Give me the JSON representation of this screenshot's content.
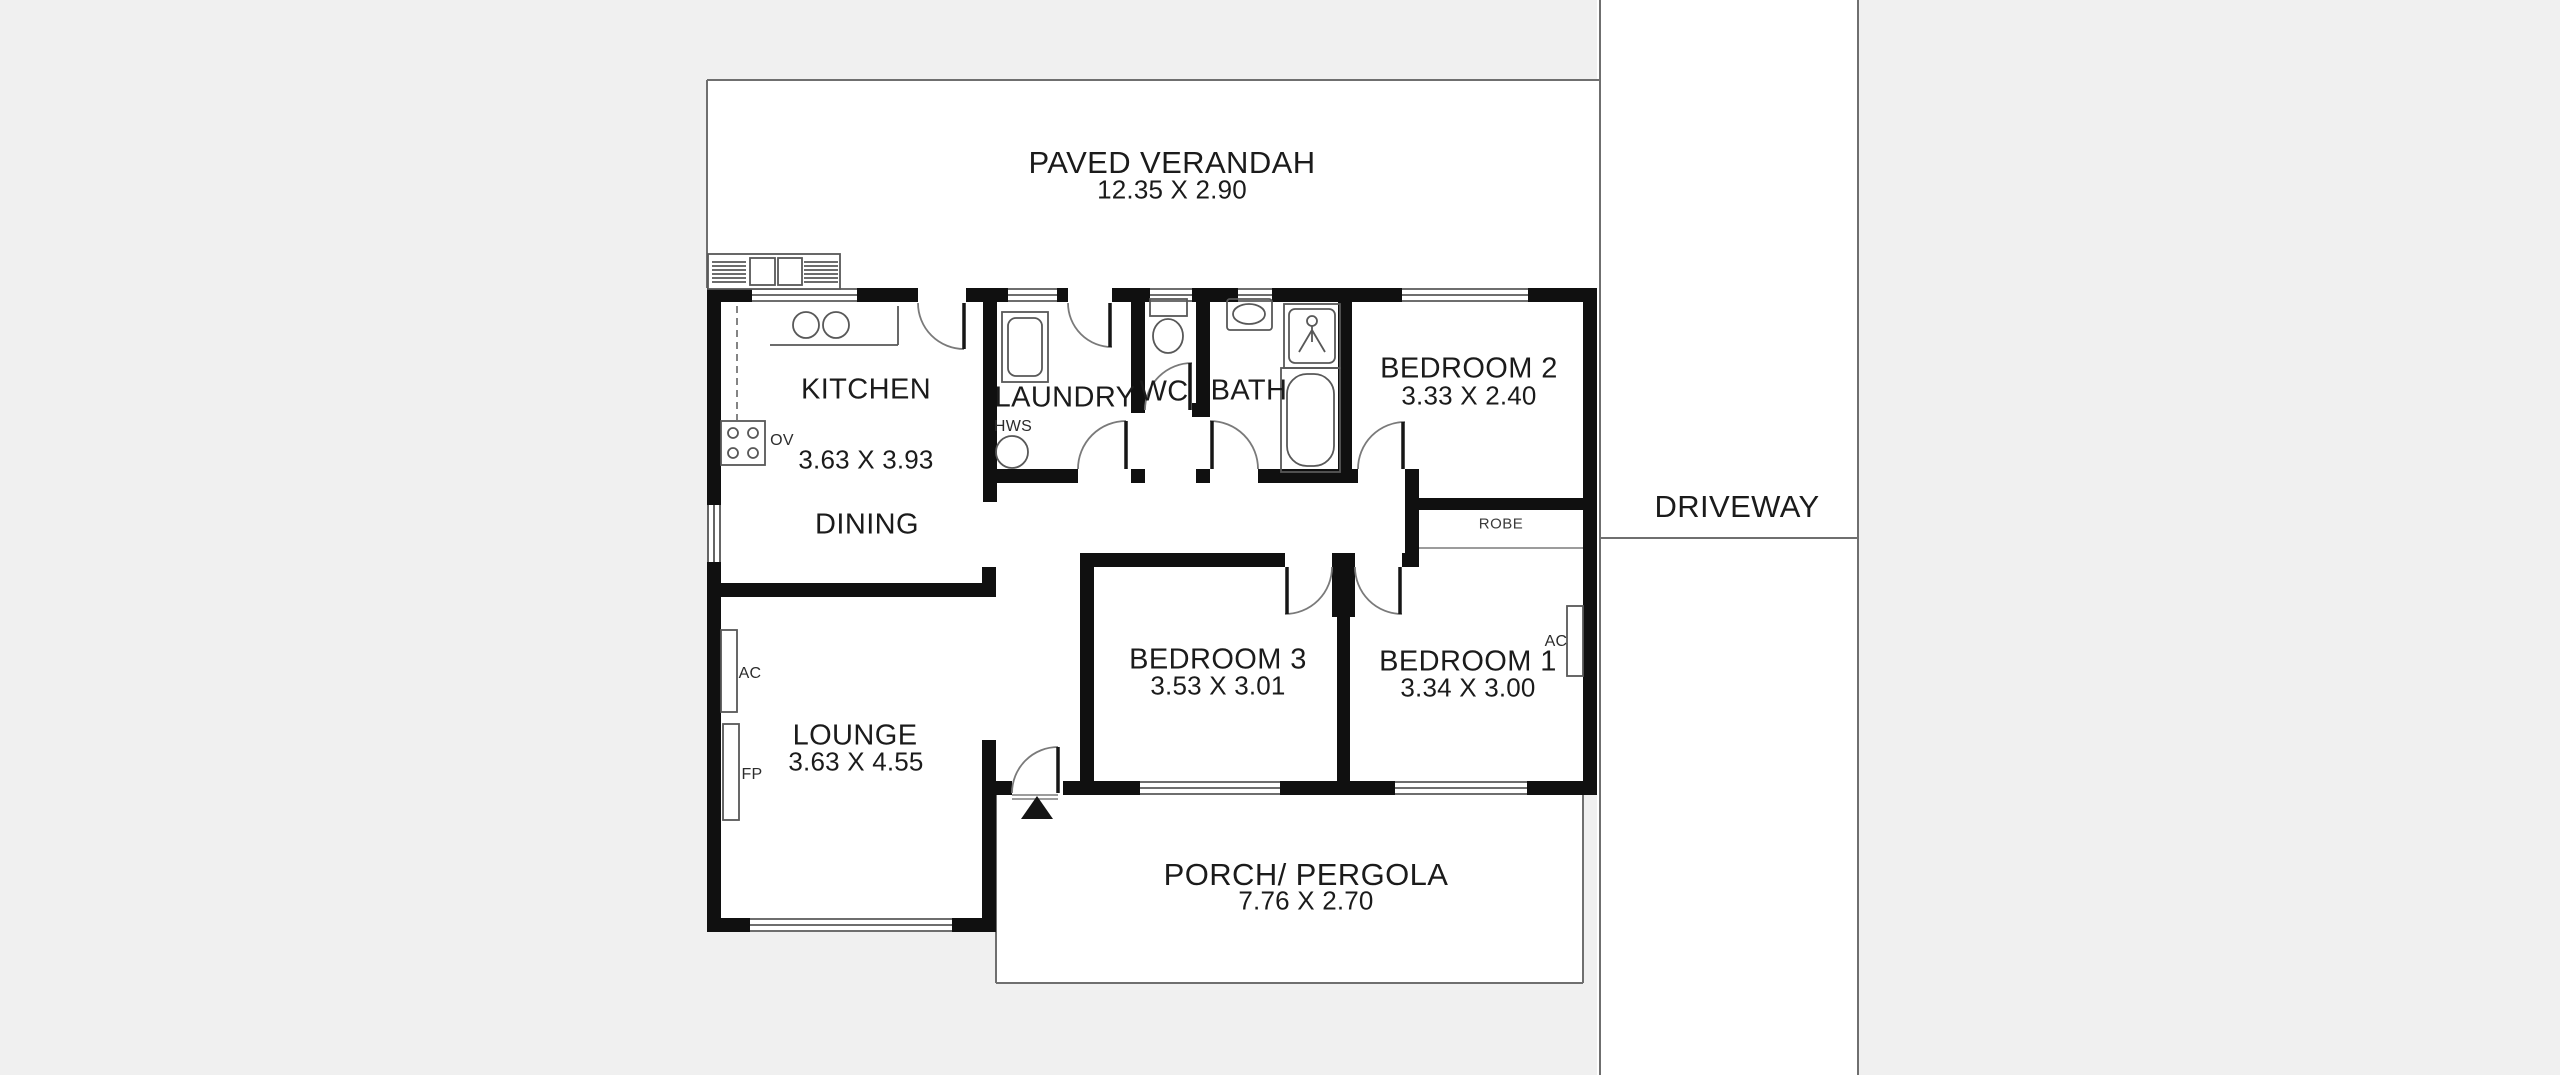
{
  "colors": {
    "background": "#f0f0f0",
    "floor": "#ffffff",
    "wall": "#101010",
    "line": "#6f6f6f"
  },
  "outdoor": {
    "verandah": {
      "name": "PAVED VERANDAH",
      "dims": "12.35 X 2.90"
    },
    "porch": {
      "name": "PORCH/ PERGOLA",
      "dims": "7.76 X 2.70"
    },
    "driveway": {
      "name": "DRIVEWAY"
    }
  },
  "rooms": {
    "kitchen": {
      "name": "KITCHEN",
      "dims": "3.63 X 3.93"
    },
    "dining": {
      "name": "DINING"
    },
    "laundry": {
      "name": "LAUNDRY"
    },
    "wc": {
      "name": "WC"
    },
    "bath": {
      "name": "BATH"
    },
    "bedroom2": {
      "name": "BEDROOM 2",
      "dims": "3.33 X 2.40"
    },
    "bedroom3": {
      "name": "BEDROOM 3",
      "dims": "3.53 X 3.01"
    },
    "bedroom1": {
      "name": "BEDROOM 1",
      "dims": "3.34 X 3.00"
    },
    "lounge": {
      "name": "LOUNGE",
      "dims": "3.63 X 4.55"
    },
    "robe": {
      "name": "ROBE"
    }
  },
  "annotations": {
    "hws": "HWS",
    "ov": "OV",
    "fp": "FP",
    "ac_lounge": "AC",
    "ac_bedroom1": "AC"
  }
}
